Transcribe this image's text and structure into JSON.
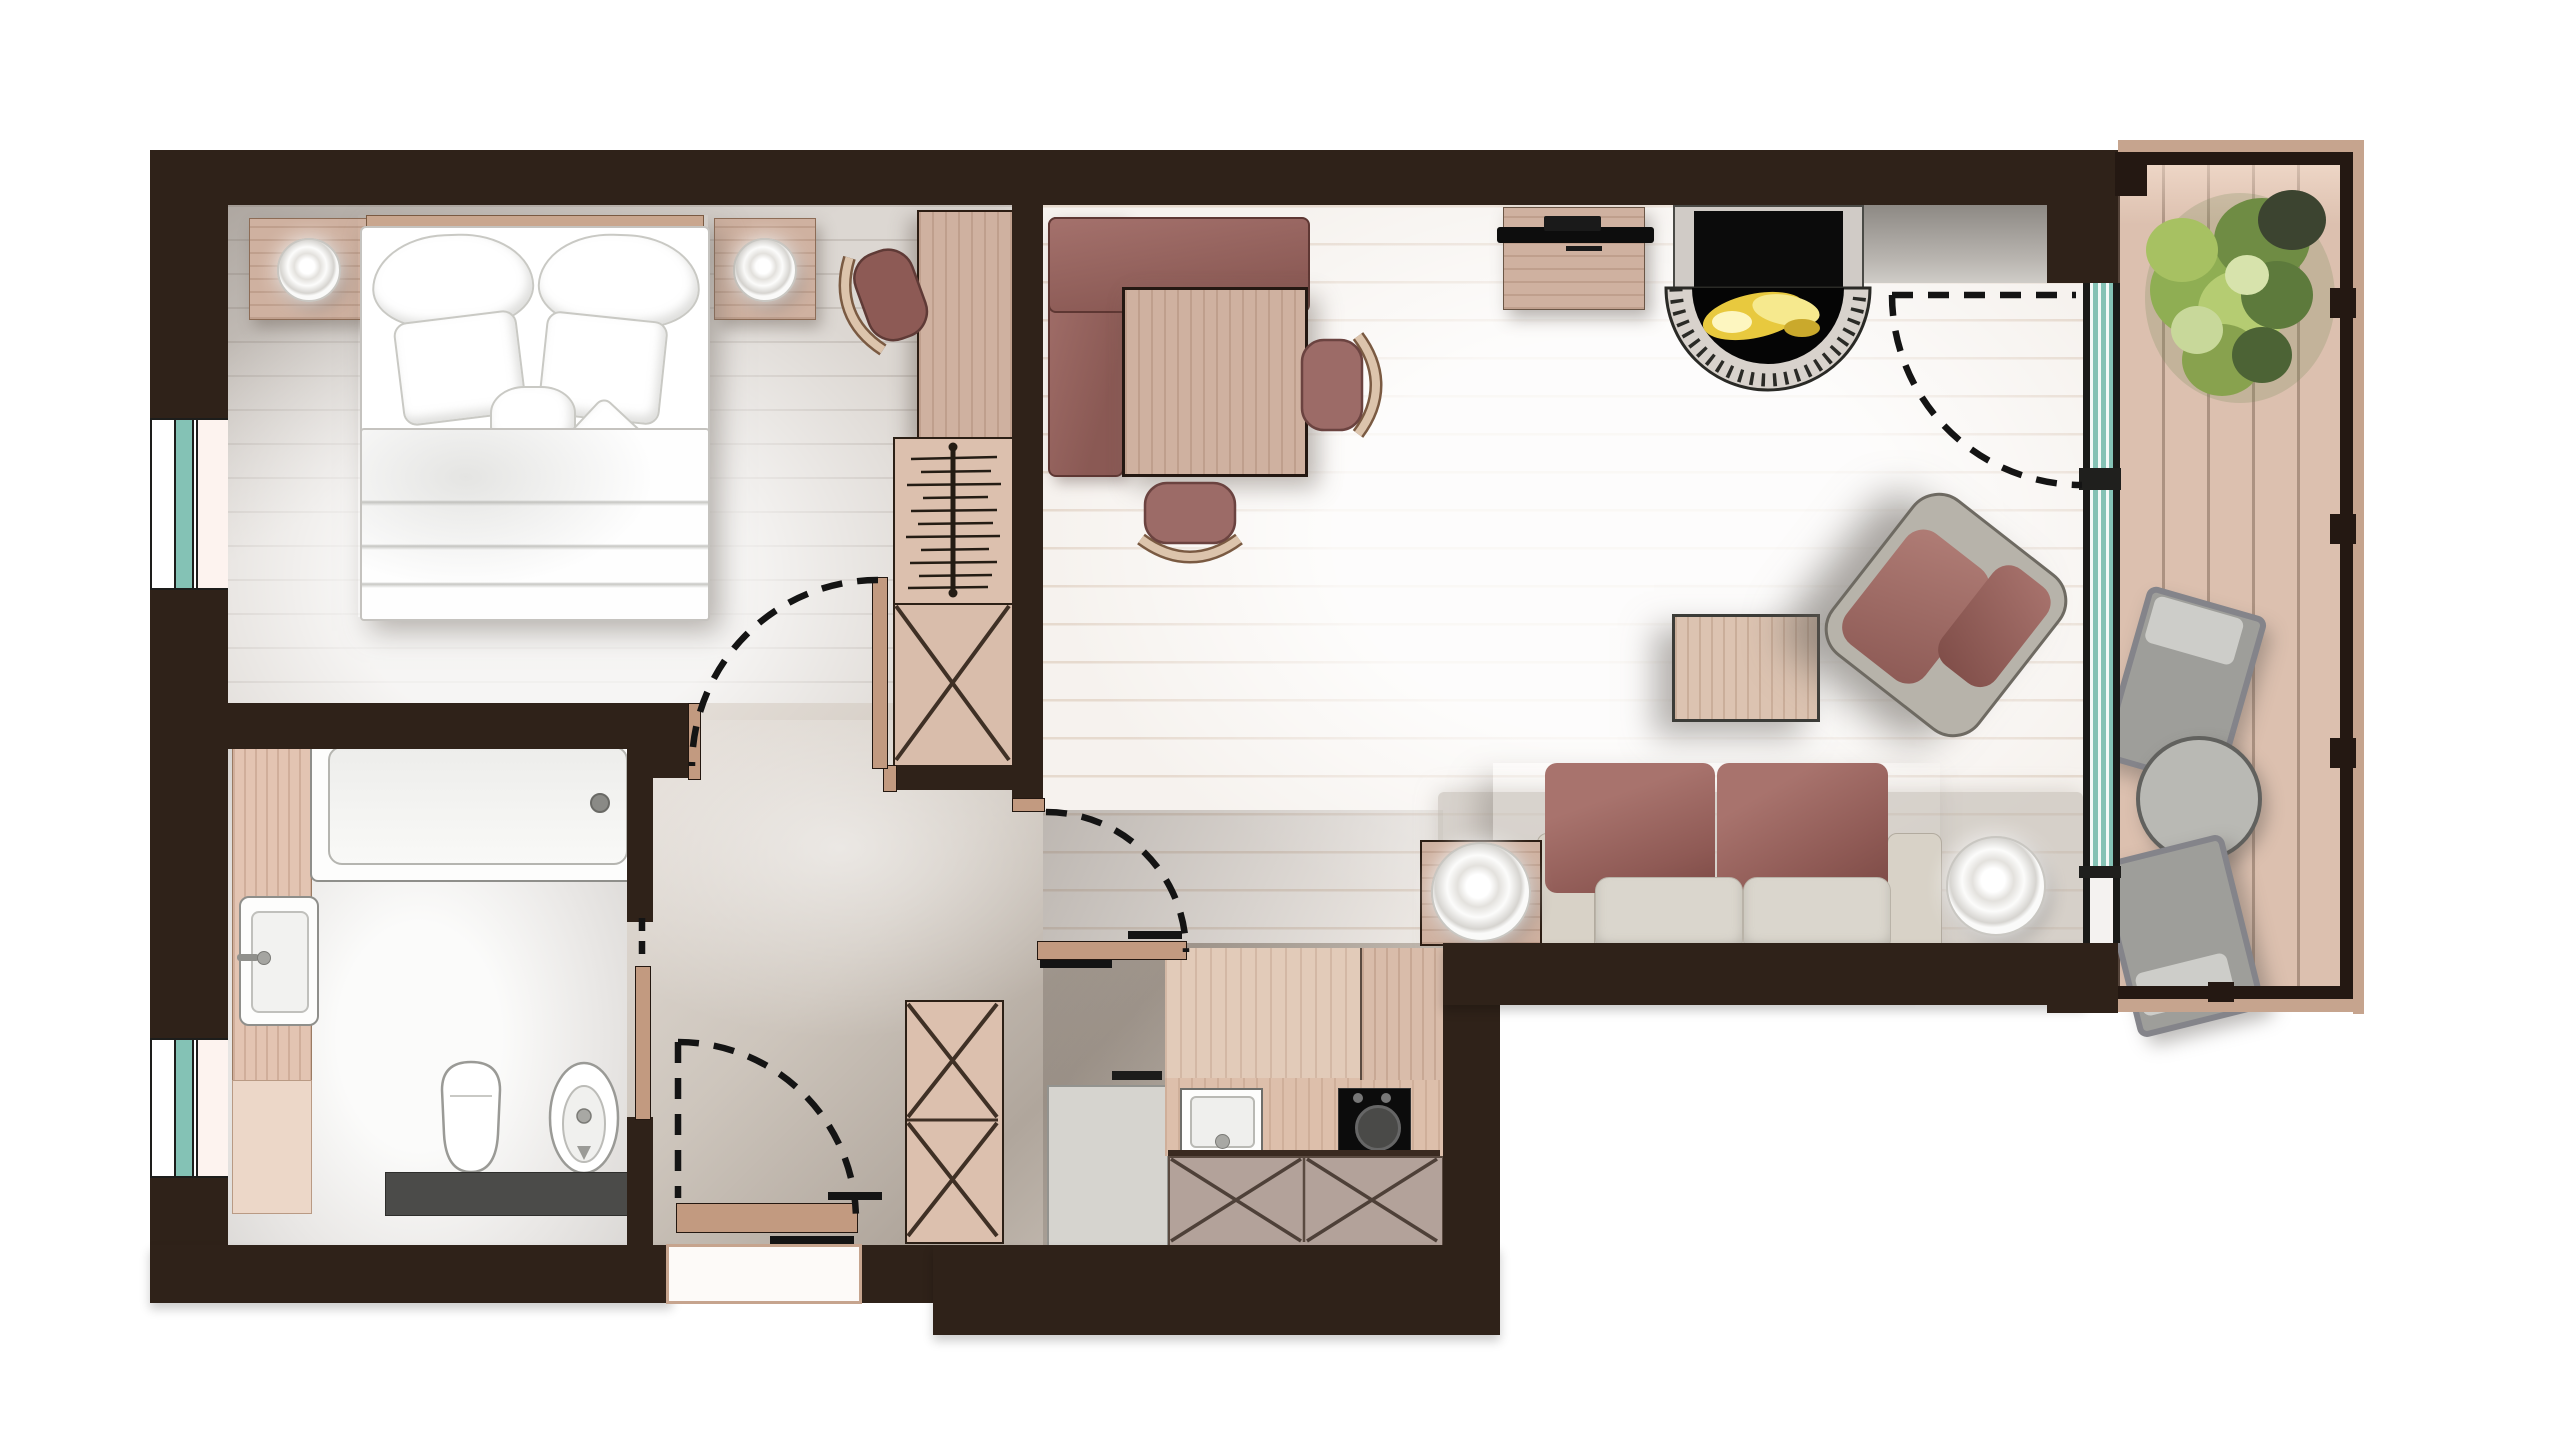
{
  "meta": {
    "kind": "architectural-floor-plan",
    "view": "top-down furnished rendering",
    "visible_text": "none"
  },
  "palette": {
    "wall": "#2f2219",
    "floor_living": "#f6f2ee",
    "floor_bedroom": "#dcd7d2",
    "floor_hall": "#cfc6bd",
    "floor_bathroom": "#edebe9",
    "balcony_deck": "#dcc0af",
    "furniture_wood": "#cfb1a0",
    "upholstery_mauve": "#9a6662",
    "sofa_grey": "#d8d3ca",
    "glazing_teal": "#84c2b5",
    "fire_flame": "#f2d94e",
    "plant_green": "#93ad58",
    "counter_dark": "#4b4b49",
    "outdoor_furniture_grey": "#a3a3a0",
    "door_leaf_tan": "#c29a80"
  },
  "rooms": [
    {
      "id": "bedroom",
      "items": [
        "double-bed",
        "headboard",
        "pillows (6)",
        "duvet",
        "nightstand-left",
        "nightstand-right",
        "table-lamp (2)",
        "dressing-desk",
        "desk-chair",
        "window"
      ]
    },
    {
      "id": "bathroom",
      "items": [
        "bathtub",
        "bathtub-faucet",
        "washbasin",
        "toilet",
        "bidet",
        "wood-vanity-panel",
        "dark-counter",
        "pocket-door",
        "window"
      ]
    },
    {
      "id": "hall",
      "items": [
        "wardrobe-hanging-rail",
        "wardrobe-crossed-compartment",
        "tall-storage-cabinet",
        "entry-door"
      ]
    },
    {
      "id": "living-dining",
      "items": [
        "corner-bench",
        "dining-table",
        "dining-chair (2)",
        "media-sideboard",
        "tv",
        "fireplace",
        "fireplace-hearth",
        "wall-niche",
        "coffee-table",
        "swivel-armchair",
        "two-seat-sofa",
        "side-table",
        "floor-lamp (2)",
        "area-rug",
        "glazed-wall"
      ]
    },
    {
      "id": "kitchen",
      "items": [
        "tall-fridge-unit",
        "sink",
        "cooktop-oven",
        "crossed-base-cabinets",
        "tall-wood-cabinet",
        "counter",
        "interior-door"
      ]
    },
    {
      "id": "balcony",
      "items": [
        "wood-decking",
        "shrub-planter",
        "outdoor-chair (2)",
        "round-bistro-table",
        "railing"
      ]
    }
  ],
  "doors": [
    {
      "id": "bedroom-door",
      "type": "hinged",
      "state": "drawn-open-90"
    },
    {
      "id": "bathroom-door",
      "type": "pocket-sliding",
      "state": "partly-open"
    },
    {
      "id": "hall-kitchen-door",
      "type": "hinged",
      "state": "drawn-open-90"
    },
    {
      "id": "entry-door",
      "type": "hinged",
      "state": "closed-with-swing-arc"
    },
    {
      "id": "balcony-door",
      "type": "hinged",
      "state": "closed-with-swing-arc"
    }
  ],
  "windows": [
    {
      "id": "bedroom-window",
      "wall": "left"
    },
    {
      "id": "bathroom-window",
      "wall": "left"
    },
    {
      "id": "living-glazed-wall",
      "wall": "right"
    }
  ]
}
